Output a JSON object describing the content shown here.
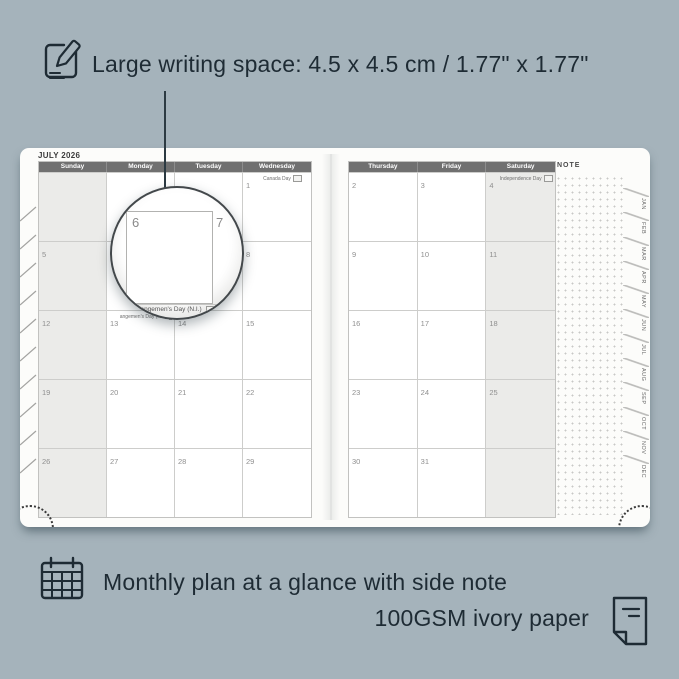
{
  "colors": {
    "background": "#a5b3bb",
    "ink": "#1e2b34",
    "header_bar": "#707070",
    "weekend_shade": "#ebebe9",
    "grid_line": "#cdcdcb",
    "page": "#fcfcfa"
  },
  "annotations": {
    "top_text": "Large writing space: 4.5 x 4.5 cm / 1.77\" x 1.77\"",
    "bottom_text_1": "Monthly plan at a glance with side note",
    "bottom_text_2": "100GSM ivory paper"
  },
  "planner": {
    "month_title": "JULY 2026",
    "note_label": "NOTE",
    "left_page": {
      "headers": [
        "Sunday",
        "Monday",
        "Tuesday",
        "Wednesday"
      ],
      "shaded_col": 0,
      "rows": [
        [
          {},
          {},
          {},
          {
            "date": "1",
            "holiday": "Canada Day",
            "flag": "CA"
          }
        ],
        [
          {
            "date": "5"
          },
          {
            "date": "6"
          },
          {
            "date": "7"
          },
          {
            "date": "8"
          }
        ],
        [
          {
            "date": "12"
          },
          {
            "date": "13",
            "holiday": "Orangemen's Day (N.I.)",
            "flag": "GB"
          },
          {
            "date": "14"
          },
          {
            "date": "15"
          }
        ],
        [
          {
            "date": "19"
          },
          {
            "date": "20"
          },
          {
            "date": "21"
          },
          {
            "date": "22"
          }
        ],
        [
          {
            "date": "26"
          },
          {
            "date": "27"
          },
          {
            "date": "28"
          },
          {
            "date": "29"
          }
        ]
      ]
    },
    "right_page": {
      "headers": [
        "Thursday",
        "Friday",
        "Saturday"
      ],
      "shaded_col": 2,
      "rows": [
        [
          {
            "date": "2"
          },
          {
            "date": "3"
          },
          {
            "date": "4",
            "holiday": "Independence Day",
            "flag": "US"
          }
        ],
        [
          {
            "date": "9"
          },
          {
            "date": "10"
          },
          {
            "date": "11"
          }
        ],
        [
          {
            "date": "16"
          },
          {
            "date": "17"
          },
          {
            "date": "18"
          }
        ],
        [
          {
            "date": "23"
          },
          {
            "date": "24"
          },
          {
            "date": "25"
          }
        ],
        [
          {
            "date": "30"
          },
          {
            "date": "31"
          },
          {}
        ]
      ]
    },
    "month_tabs": [
      "JAN",
      "FEB",
      "MAR",
      "APR",
      "MAY",
      "JUN",
      "JUL",
      "AUG",
      "SEP",
      "OCT",
      "NOV",
      "DEC"
    ]
  },
  "magnifier": {
    "date_left": "6",
    "date_right": "7",
    "below_date": "13",
    "holiday": "Orangemen's Day (N.I.)"
  }
}
